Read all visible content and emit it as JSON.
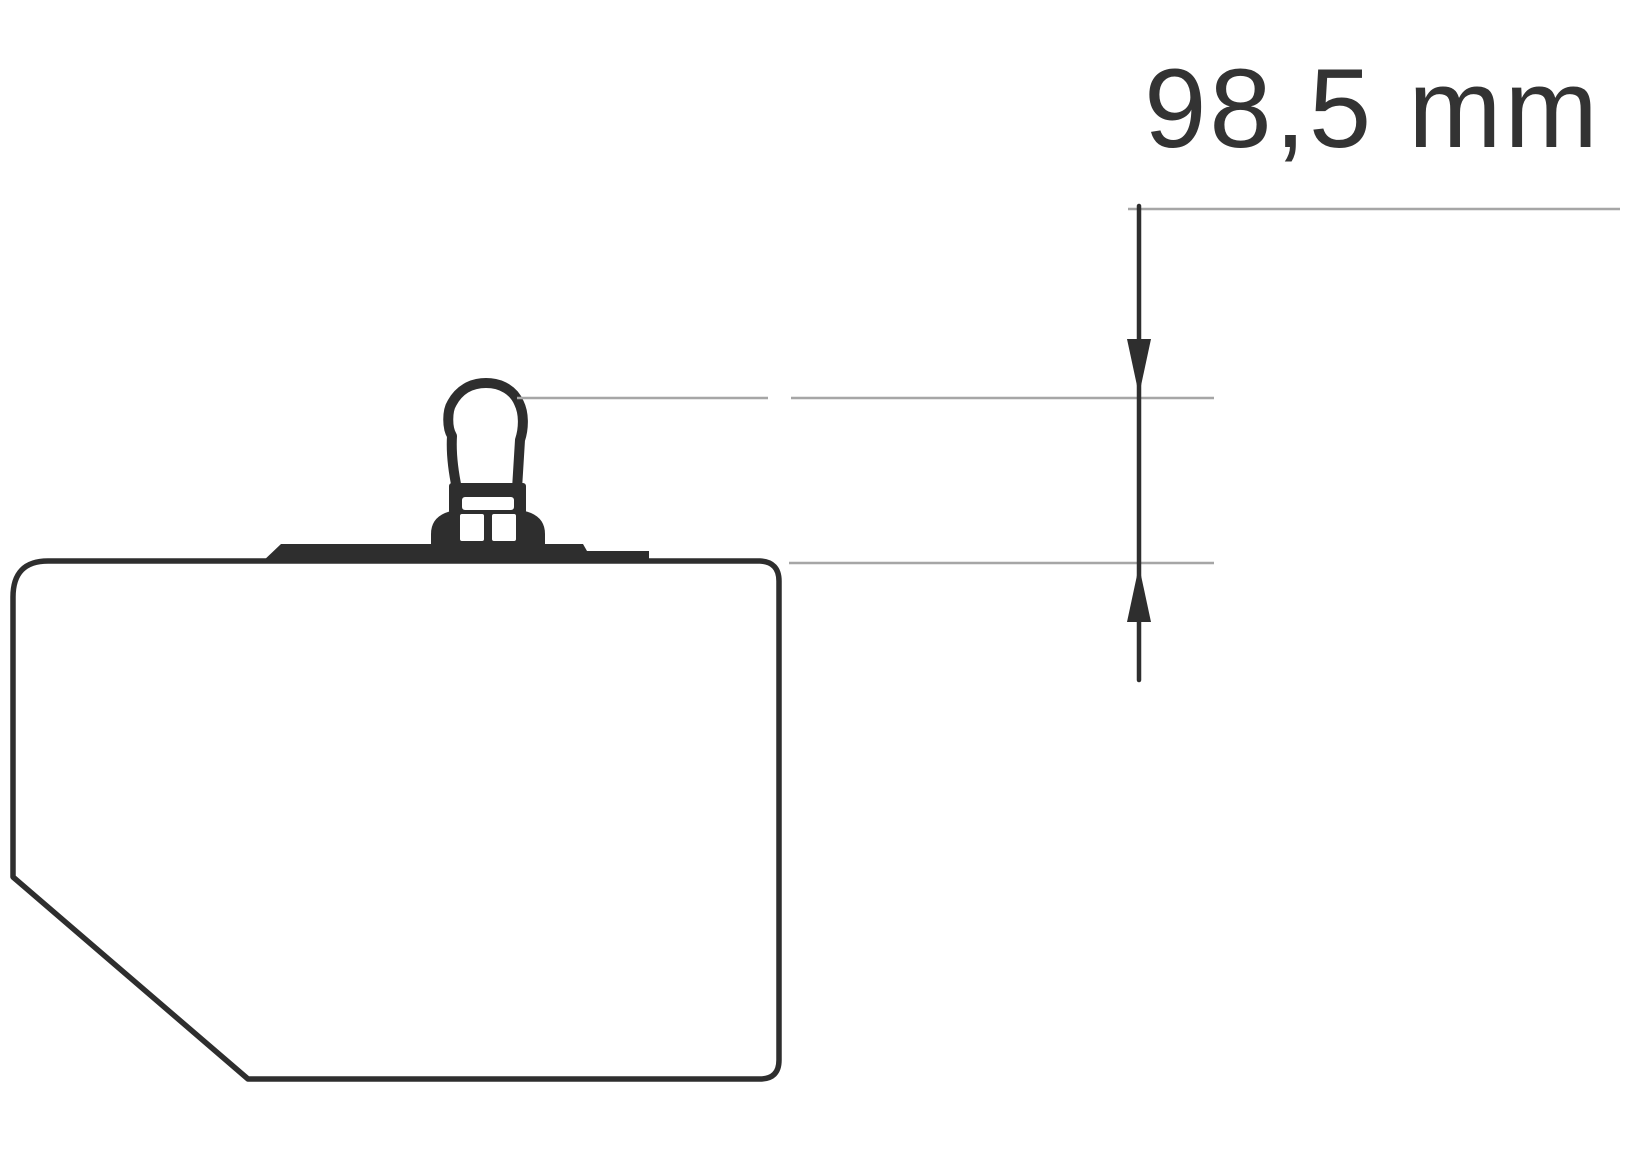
{
  "dimension": {
    "label": "98,5 mm",
    "value": "98,5",
    "unit": "mm"
  },
  "colors": {
    "line_dark": "#2e2e2e",
    "line_light": "#a6a6a6",
    "text": "#333333",
    "background": "#ffffff"
  },
  "icons": {
    "arrow_down": "dimension arrowhead pointing down",
    "arrow_up": "dimension arrowhead pointing up"
  }
}
